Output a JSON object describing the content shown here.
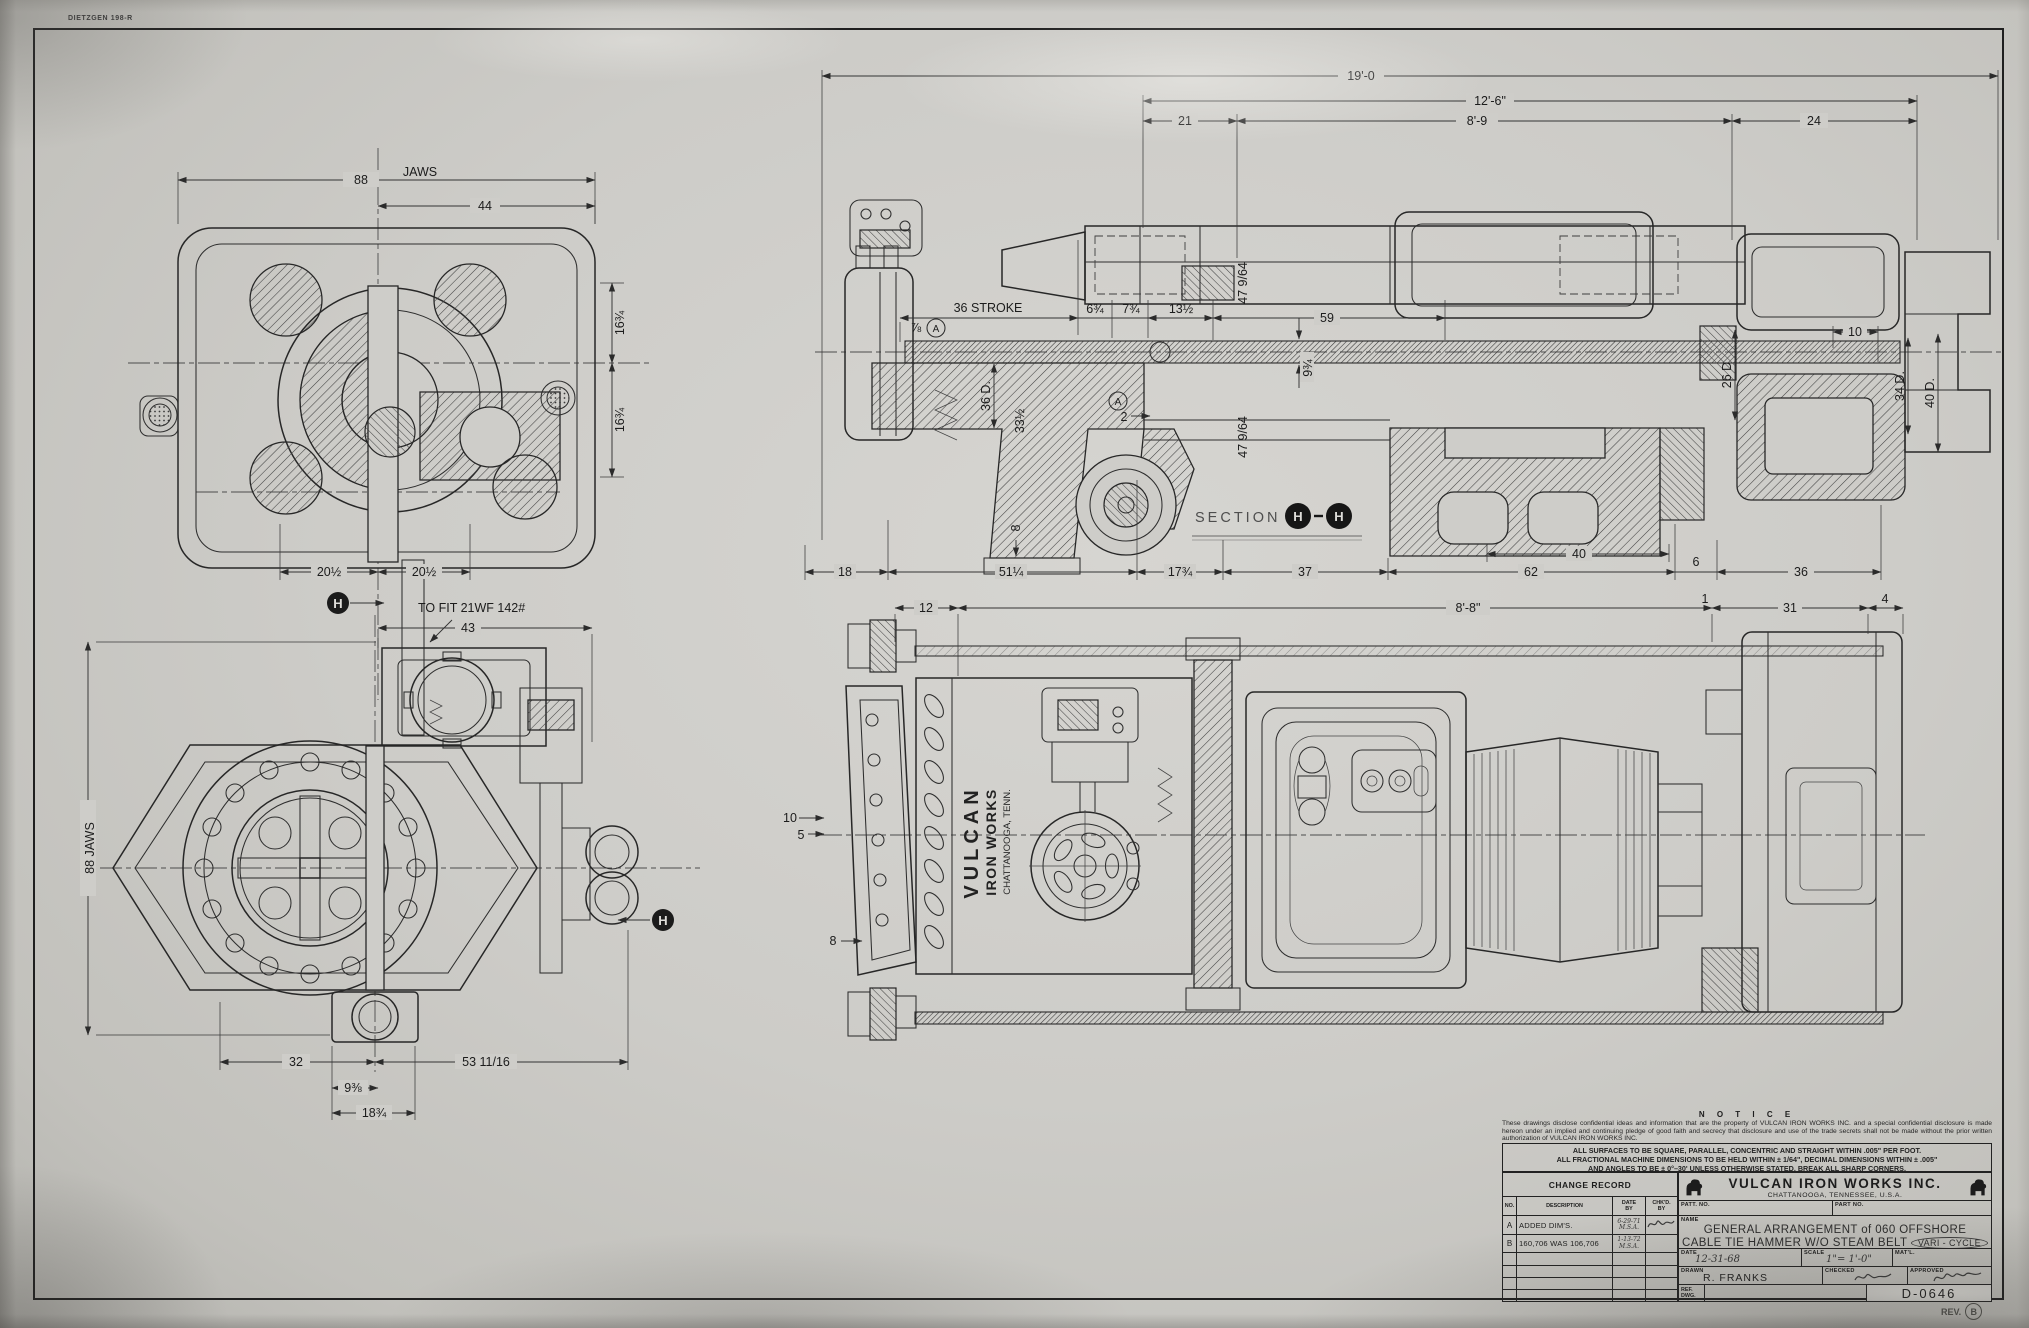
{
  "meta": {
    "stamp": "DIETZGEN 198-R"
  },
  "plan_view": {
    "d88": "88",
    "jaws": "JAWS",
    "d44": "44",
    "d16_upper": "16¾",
    "d16_lower": "16¾",
    "d20_left": "20½",
    "d20_right": "20½"
  },
  "front_view": {
    "h": "H",
    "fit_note": "TO FIT 21WF 142#",
    "d43": "43",
    "d88jaws": "88 JAWS",
    "d32": "32",
    "d53": "53 11/16",
    "d9": "9⅜",
    "d18": "18¾"
  },
  "section_view": {
    "label": "SECTION",
    "h": "H",
    "d19ft": "19'-0",
    "d12ft6": "12'-6\"",
    "d21": "21",
    "d8ft9": "8'-9",
    "d24": "24",
    "stroke": "36 STROKE",
    "d6_34": "6¾",
    "d7_34": "7¾",
    "d13_12": "13½",
    "d59": "59",
    "d47_upper": "47 9/64",
    "d47_lower": "47 9/64",
    "d9_34": "9¾",
    "d36d": "36 D.",
    "d33_12": "33½",
    "d2": "2",
    "d8": "8",
    "d7_8": "⅞",
    "a": "A",
    "d10": "10",
    "d26d": "26 D",
    "d34d": "34 D.",
    "d40d": "40 D.",
    "b18": "18",
    "b51": "51¼",
    "b17": "17¾",
    "b37": "37",
    "b62": "62",
    "b6": "6",
    "b36": "36",
    "b40": "40"
  },
  "side_view": {
    "brand1": "VULCAN",
    "brand2": "IRON WORKS",
    "brand3": "CHATTANOOGA, TENN.",
    "d12": "12",
    "d8ft8": "8'-8\"",
    "d1": "1",
    "d31": "31",
    "d4": "4",
    "d10": "10",
    "d5": "5",
    "d8": "8"
  },
  "title_block": {
    "notice_title": "N O T I C E",
    "notice_body": "These drawings disclose confidential ideas and information that are the property of VULCAN IRON WORKS INC. and a special confidential disclosure is made hereon under an implied and continuing pledge of good faith and secrecy that disclosure and use of the trade secrets shall not be made without the prior written authorization of VULCAN IRON WORKS INC.",
    "tol1": "ALL SURFACES TO BE SQUARE, PARALLEL, CONCENTRIC AND STRAIGHT WITHIN .005\" PER FOOT.",
    "tol2": "ALL FRACTIONAL MACHINE DIMENSIONS TO BE HELD WITHIN ± 1/64\", DECIMAL DIMENSIONS WITHIN ± .005\"",
    "tol3": "AND ANGLES TO BE ± 0°–30' UNLESS OTHERWISE STATED. BREAK ALL SHARP CORNERS.",
    "change_title": "CHANGE RECORD",
    "col_no": "NO.",
    "col_desc": "DESCRIPTION",
    "col_date": "DATE",
    "col_by": "BY",
    "col_chkd": "CHK'D.",
    "changes": [
      {
        "no": "A",
        "description": "ADDED DIM'S.",
        "date": "6-29-71",
        "by": "M.S.A."
      },
      {
        "no": "B",
        "description": "160,706 WAS 106,706",
        "date": "1-13-72",
        "by": "M.S.A."
      }
    ],
    "company": "VULCAN IRON WORKS INC.",
    "company_city": "CHATTANOOGA, TENNESSEE, U.S.A.",
    "patt_label": "PATT. NO.",
    "part_label": "PART NO.",
    "name_label": "NAME",
    "title_line1": "GENERAL ARRANGEMENT of 060 OFFSHORE",
    "title_line2": "CABLE TIE HAMMER  W/O STEAM BELT",
    "title_note": "VARI - CYCLE",
    "date_label": "DATE",
    "date_value": "12-31-68",
    "scale_label": "SCALE",
    "scale_value": "1\"= 1'-0\"",
    "matl_label": "MAT'L.",
    "drawn_label": "DRAWN",
    "drawn_value": "R. FRANKS",
    "checked_label": "CHECKED",
    "approved_label": "APPROVED",
    "ref_line1": "REF.",
    "ref_line2": "DWG.",
    "dwg_no": "D-0646",
    "rev_label": "REV.",
    "rev_value": "B"
  }
}
